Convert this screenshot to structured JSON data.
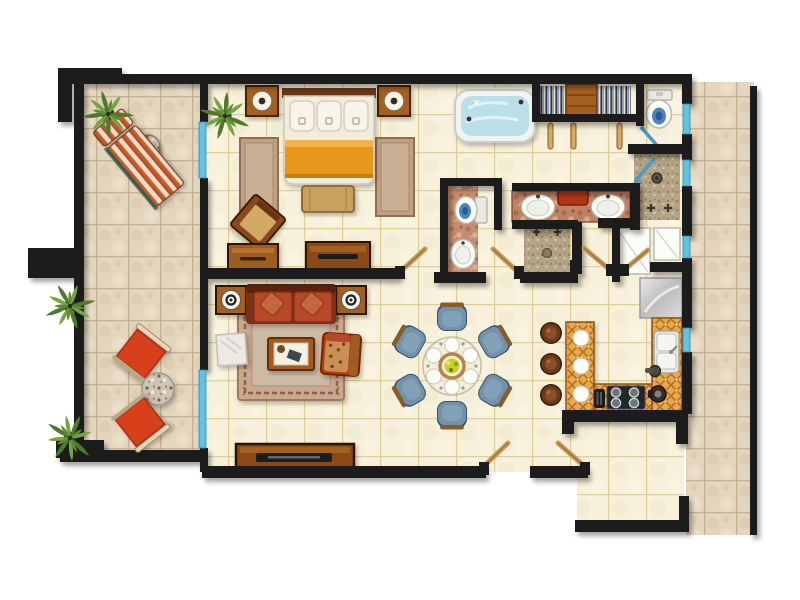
{
  "meta": {
    "type": "architectural-floor-plan",
    "view": "top-down-render",
    "description": "One-bedroom apartment floor plan with wrap-around outdoor terraces, rendered with furniture",
    "canvas": {
      "width": 800,
      "height": 600
    }
  },
  "palette": {
    "wall": "#1c1c1c",
    "outdoor_tile": "#e4d5bd",
    "outdoor_grout": "#bdac92",
    "indoor_tile": "#f7f0da",
    "indoor_grout": "#ddca90",
    "water_blue": "#badfe9",
    "glass_door_blue": "#5ec3e4",
    "wood_dark": "#6b3414",
    "wood_mid": "#a4601e",
    "wood_light": "#d7a967",
    "sofa_red": "#b5492a",
    "lounge_red": "#d8401c",
    "chaise_stripe_red": "#b5441f",
    "chaise_stripe_cream": "#f0ddc8",
    "duvet_orange": "#e8971d",
    "dining_chair_blue": "#7291ab",
    "counter_orange": "#e8a84c",
    "rug_tan": "#c9a98e",
    "marble_counter_brown": "#c08163",
    "shower_tile_tan": "#b4a384",
    "stainless_gray": "#cfcfcf",
    "palm_green": "#5d8c36"
  },
  "rooms": [
    {
      "id": "terrace-left",
      "label": "outdoor terrace (left)",
      "floor": "outdoor beige tile"
    },
    {
      "id": "bedroom",
      "label": "bedroom",
      "floor": "indoor cream tile"
    },
    {
      "id": "living-room",
      "label": "living room",
      "floor": "indoor cream tile"
    },
    {
      "id": "dining-area",
      "label": "dining area",
      "floor": "indoor cream tile"
    },
    {
      "id": "kitchen",
      "label": "kitchen",
      "floor": "indoor cream tile"
    },
    {
      "id": "master-bathroom",
      "label": "master bathroom with jacuzzi",
      "floor": "indoor cream tile"
    },
    {
      "id": "walk-in-closet",
      "label": "walk-in closet",
      "floor": "indoor cream tile"
    },
    {
      "id": "toilet-room",
      "label": "toilet room",
      "floor": "indoor cream tile"
    },
    {
      "id": "powder-room",
      "label": "powder room",
      "floor": "marble strip"
    },
    {
      "id": "shower-rooms",
      "label": "two tiled shower stalls",
      "floor": "speckled tan tile"
    },
    {
      "id": "entry-hall",
      "label": "entry hall (bottom right)",
      "floor": "indoor cream tile"
    },
    {
      "id": "walkway-right",
      "label": "outdoor walkway (right)",
      "floor": "outdoor beige tile"
    }
  ],
  "furniture_inventory": {
    "terraces": [
      "striped chaise lounge",
      "round stone side table",
      "2 red sling chairs",
      "round marble table",
      "4 potted palm plants"
    ],
    "bedroom": [
      "double bed with 3 pillows and orange duvet",
      "2 wooden nightstands with round lamps",
      "2 area rugs",
      "foot bench",
      "angled accent chair",
      "2 dressers",
      "sliding glass door"
    ],
    "living_room": [
      "red two-seat sofa with 2 throw pillows",
      "2 speaker end-tables",
      "ornate area rug",
      "coffee table with book",
      "red armchair with leopard cushion",
      "white marble side table",
      "TV console with television",
      "sliding glass door"
    ],
    "dining_area": [
      "round glass dining table",
      "6 blue dining chairs",
      "6 white place settings",
      "flower centerpiece"
    ],
    "kitchen": [
      "L-shaped orange tile counter",
      "breakfast bar with 3 plates",
      "3 round bar stools",
      "4-burner cooktop",
      "toaster",
      "coffee maker",
      "double sink",
      "stainless counter / refrigerator"
    ],
    "bathrooms": [
      "jacuzzi tub",
      "double-sink marble vanity with red tray",
      "third vanity sink",
      "2 toilets",
      "pedestal sink",
      "2 tiled showers with fixtures",
      "closet with hanging clothes and shelf unit",
      "2 white linen closets"
    ]
  },
  "doors": {
    "interior_wood_doors": 6,
    "sliding_glass_doors": 2,
    "glass_swing_indicators": 2,
    "glass_wall_panels": 8,
    "closet_rail_panels": 3
  }
}
